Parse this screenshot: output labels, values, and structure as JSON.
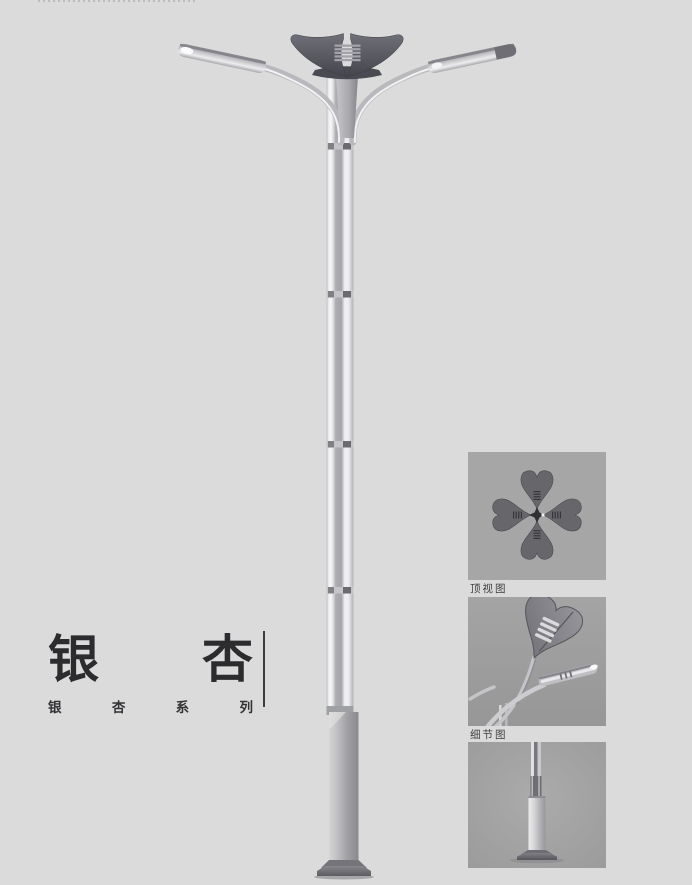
{
  "page": {
    "background": "#dbdbdc"
  },
  "brand": {
    "title": "银杏",
    "title_chars": [
      "银",
      "杏"
    ],
    "series": "银杏系列",
    "series_chars": [
      "银",
      "杏",
      "系",
      "列"
    ]
  },
  "figures": [
    {
      "id": "top-view",
      "caption": "顶视图"
    },
    {
      "id": "detail-view",
      "caption": "细节图"
    },
    {
      "id": "base-view",
      "caption": ""
    }
  ],
  "colors": {
    "text": "#2c2c2e",
    "rule": "#3c3c3e",
    "figure_background": "#a6a6a6",
    "metal_light": "#ececee",
    "metal_mid": "#b5b5b9",
    "crown_dark": "#50505a"
  }
}
